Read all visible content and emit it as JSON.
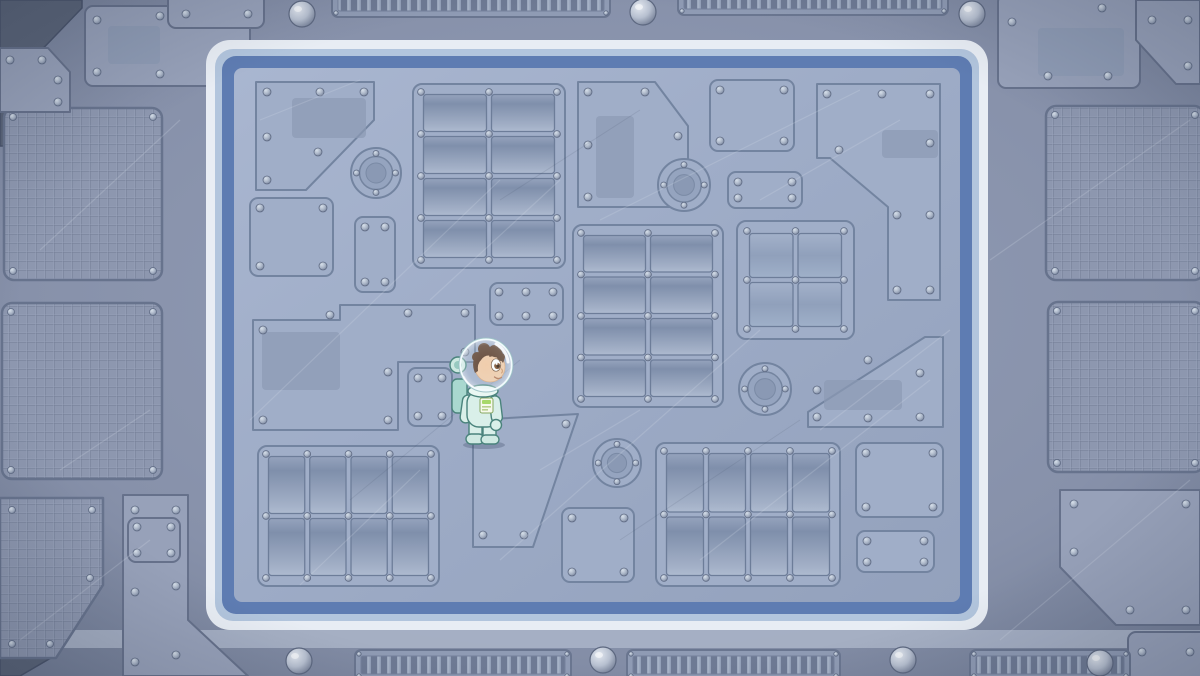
{
  "scene": {
    "title": "Space station deck - top-down game view with astronaut",
    "width": 1200,
    "height": 676
  },
  "colors": {
    "outer_floor": "#8791aa",
    "outer_floor_dark": "#6d7890",
    "outer_plate": "#97a1b9",
    "outer_plate_edge": "#66718b",
    "mesh_fill": "#8d97af",
    "mesh_line": "#6e7992",
    "corner_dark": "#5a6478",
    "floor_light": "#a9b6d0",
    "floor": "#9dabc6",
    "floor_dark": "#93a1bc",
    "panel_fill": "#a0aec8",
    "panel_inner": "#8c9ab4",
    "panel_edge_dark": "#7384a0",
    "panel_edge_light": "#bac6d8",
    "border_white": "#e8edf4",
    "border_light_blue": "#b2c5dd",
    "border_blue": "#5e7cb2",
    "band_light": "#a8b2c6",
    "rivet_edge": "#5f6b84",
    "scratch_light": "#dde4ee",
    "scratch_dark": "#3a465e"
  },
  "frame": {
    "x": 206,
    "y": 40,
    "w": 782,
    "h": 590,
    "r": 24,
    "stripe_white": 9,
    "stripe_light": 7,
    "stripe_blue": 12
  },
  "floor": {
    "x": 234,
    "y": 68,
    "w": 726,
    "h": 534
  },
  "character": {
    "name": "astronaut-kid",
    "description": "Cartoon child astronaut in pale mint spacesuit with round glass helmet, brown curly hair, facing right, standing",
    "x": 451,
    "y": 335,
    "w": 62,
    "h": 112,
    "facing": "right",
    "suit_color": "#d9efe9",
    "suit_shade": "#a9d8cf",
    "outline": "#4a837c",
    "skin": "#f2c9a4",
    "hair": "#5b3b28",
    "badge_color": "#a8d86a"
  },
  "panels": [
    {
      "kind": "plate",
      "points": "256,82 374,82 374,120 306,190 256,190",
      "inner": [
        292,
        98,
        74,
        40
      ],
      "rivets": [
        [
          267,
          92
        ],
        [
          320,
          92
        ],
        [
          364,
          92
        ],
        [
          267,
          137
        ],
        [
          267,
          180
        ],
        [
          318,
          152
        ]
      ]
    },
    {
      "kind": "vent",
      "x": 413,
      "y": 84,
      "w": 152,
      "h": 184,
      "cols": 2,
      "rows": 4
    },
    {
      "kind": "plate",
      "points": "578,82 655,82 688,126 688,207 578,207",
      "inner": [
        596,
        116,
        38,
        82
      ],
      "rivets": [
        [
          588,
          92
        ],
        [
          645,
          92
        ],
        [
          678,
          136
        ],
        [
          678,
          197
        ],
        [
          588,
          197
        ],
        [
          588,
          145
        ]
      ]
    },
    {
      "kind": "plate",
      "x": 710,
      "y": 80,
      "w": 84,
      "h": 71
    },
    {
      "kind": "plate",
      "points": "817,84 940,84 940,300 888,300 888,207 830,158 817,158",
      "inner": [
        882,
        130,
        56,
        28
      ],
      "rivets": [
        [
          827,
          94
        ],
        [
          882,
          94
        ],
        [
          930,
          94
        ],
        [
          930,
          143
        ],
        [
          839,
          150
        ],
        [
          897,
          215
        ],
        [
          930,
          215
        ],
        [
          897,
          290
        ],
        [
          930,
          290
        ]
      ]
    },
    {
      "kind": "plate",
      "x": 728,
      "y": 172,
      "w": 74,
      "h": 36
    },
    {
      "kind": "grid",
      "x": 737,
      "y": 221,
      "w": 117,
      "h": 118,
      "cols": 2,
      "rows": 2
    },
    {
      "kind": "vent",
      "x": 573,
      "y": 225,
      "w": 150,
      "h": 182,
      "cols": 2,
      "rows": 4
    },
    {
      "kind": "porthole",
      "cx": 684,
      "cy": 185,
      "r": 26
    },
    {
      "kind": "porthole",
      "cx": 765,
      "cy": 389,
      "r": 26
    },
    {
      "kind": "porthole",
      "cx": 617,
      "cy": 463,
      "r": 24
    },
    {
      "kind": "porthole",
      "cx": 376,
      "cy": 173,
      "r": 25
    },
    {
      "kind": "plate",
      "x": 250,
      "y": 198,
      "w": 83,
      "h": 78
    },
    {
      "kind": "plate",
      "x": 355,
      "y": 217,
      "w": 40,
      "h": 75
    },
    {
      "kind": "plate",
      "points": "253,320 340,320 340,305 475,305 475,362 398,362 398,430 253,430",
      "inner": [
        262,
        332,
        78,
        58
      ],
      "rivets": [
        [
          263,
          330
        ],
        [
          330,
          315
        ],
        [
          408,
          313
        ],
        [
          465,
          313
        ],
        [
          465,
          352
        ],
        [
          263,
          420
        ],
        [
          388,
          420
        ],
        [
          388,
          372
        ]
      ]
    },
    {
      "kind": "plate",
      "x": 408,
      "y": 368,
      "w": 44,
      "h": 58
    },
    {
      "kind": "plate",
      "x": 490,
      "y": 283,
      "w": 73,
      "h": 42,
      "rivets": [
        [
          499,
          292
        ],
        [
          526,
          292
        ],
        [
          553,
          292
        ],
        [
          499,
          316
        ],
        [
          526,
          316
        ],
        [
          553,
          316
        ]
      ]
    },
    {
      "kind": "vent",
      "x": 258,
      "y": 446,
      "w": 181,
      "h": 140,
      "cols": 4,
      "rows": 2
    },
    {
      "kind": "plate",
      "points": "473,420 578,414 533,547 473,547",
      "rivets": [
        [
          483,
          430
        ],
        [
          566,
          424
        ],
        [
          524,
          535
        ],
        [
          483,
          535
        ]
      ]
    },
    {
      "kind": "plate",
      "x": 562,
      "y": 508,
      "w": 72,
      "h": 74
    },
    {
      "kind": "vent",
      "x": 656,
      "y": 443,
      "w": 184,
      "h": 143,
      "cols": 4,
      "rows": 2
    },
    {
      "kind": "plate",
      "x": 856,
      "y": 443,
      "w": 87,
      "h": 74
    },
    {
      "kind": "plate",
      "x": 857,
      "y": 531,
      "w": 77,
      "h": 41
    },
    {
      "kind": "plate",
      "points": "925,337 943,337 943,427 808,427 808,412",
      "inner": [
        824,
        380,
        78,
        30
      ],
      "rivets": [
        [
          868,
          360
        ],
        [
          920,
          373
        ],
        [
          817,
          390
        ],
        [
          817,
          417
        ],
        [
          868,
          418
        ],
        [
          920,
          417
        ]
      ]
    }
  ],
  "outer": {
    "plates": [
      {
        "x": 85,
        "y": 6,
        "w": 165,
        "h": 80,
        "inner": [
          108,
          26,
          52,
          38
        ],
        "rivets": [
          [
            97,
            20
          ],
          [
            160,
            16
          ],
          [
            238,
            16
          ],
          [
            97,
            72
          ],
          [
            160,
            74
          ],
          [
            238,
            70
          ]
        ]
      },
      {
        "x": 168,
        "y": -12,
        "w": 96,
        "h": 40,
        "rivets": [
          [
            186,
            14
          ],
          [
            248,
            14
          ]
        ]
      },
      {
        "points": "0,48 48,48 70,72 70,112 0,112",
        "rivets": [
          [
            10,
            60
          ],
          [
            42,
            60
          ],
          [
            58,
            80
          ],
          [
            58,
            102
          ]
        ]
      },
      {
        "x": 998,
        "y": -6,
        "w": 142,
        "h": 94,
        "inner": [
          1038,
          28,
          86,
          48
        ],
        "rivets": [
          [
            1012,
            22
          ],
          [
            1102,
            8
          ],
          [
            1048,
            76
          ],
          [
            1108,
            76
          ]
        ]
      },
      {
        "points": "1136,0 1200,0 1200,84 1176,84 1136,40",
        "rivets": [
          [
            1152,
            20
          ],
          [
            1188,
            20
          ],
          [
            1188,
            66
          ]
        ]
      },
      {
        "points": "1060,490 1200,490 1200,625 1116,625 1060,567",
        "rivets": [
          [
            1074,
            504
          ],
          [
            1186,
            504
          ],
          [
            1074,
            552
          ],
          [
            1130,
            610
          ],
          [
            1186,
            610
          ]
        ]
      },
      {
        "x": 1128,
        "y": 632,
        "w": 80,
        "h": 50,
        "rivets": [
          [
            1142,
            652
          ],
          [
            1190,
            652
          ]
        ]
      },
      {
        "points": "123,495 188,495 188,620 248,676 123,676",
        "rivets": [
          [
            135,
            510
          ],
          [
            176,
            510
          ],
          [
            135,
            592
          ],
          [
            176,
            586
          ],
          [
            135,
            662
          ],
          [
            176,
            655
          ]
        ]
      },
      {
        "x": 128,
        "y": 518,
        "w": 52,
        "h": 44,
        "rivets": [
          [
            137,
            527
          ],
          [
            171,
            527
          ],
          [
            137,
            553
          ],
          [
            171,
            553
          ]
        ]
      }
    ],
    "dark_pieces": [
      "0,0 82,0 82,8 30,62 0,62",
      "0,112 70,112 42,146 0,146",
      "0,655 56,655 20,676 0,676"
    ],
    "meshes": [
      {
        "x": 4,
        "y": 108,
        "w": 158,
        "h": 172
      },
      {
        "x": 2,
        "y": 303,
        "w": 160,
        "h": 176
      },
      {
        "points": "0,498 103,498 103,585 56,658 0,658",
        "rivets": [
          [
            12,
            510
          ],
          [
            92,
            510
          ],
          [
            90,
            578
          ],
          [
            50,
            644
          ],
          [
            12,
            644
          ]
        ]
      },
      {
        "x": 1046,
        "y": 106,
        "w": 158,
        "h": 174
      },
      {
        "x": 1048,
        "y": 302,
        "w": 156,
        "h": 170
      }
    ],
    "top": {
      "domes": [
        [
          302,
          14
        ],
        [
          643,
          12
        ],
        [
          972,
          14
        ]
      ],
      "grilles": [
        [
          332,
          -10,
          278,
          27
        ],
        [
          678,
          -12,
          270,
          27
        ]
      ]
    },
    "bottom": {
      "band_y": 630,
      "band_h": 18,
      "domes": [
        [
          299,
          661
        ],
        [
          603,
          660
        ],
        [
          903,
          660
        ],
        [
          1100,
          663
        ]
      ],
      "grilles": [
        [
          355,
          650,
          216,
          30
        ],
        [
          627,
          650,
          213,
          30
        ],
        [
          970,
          650,
          160,
          30
        ]
      ]
    }
  }
}
